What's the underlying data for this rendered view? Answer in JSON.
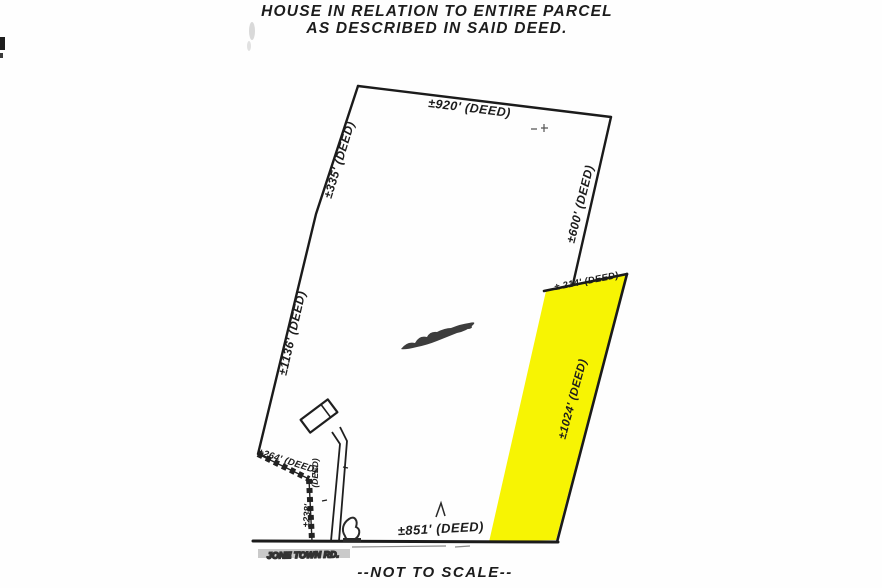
{
  "document": {
    "title_line1": "HOUSE IN RELATION TO ENTIRE PARCEL",
    "title_line2": "AS DESCRIBED IN SAID DEED.",
    "scale_note": "--NOT TO SCALE--"
  },
  "road": {
    "name": "JONE TOWN RD."
  },
  "colors": {
    "highlight": "#f7f403",
    "ink": "#1c1c1c"
  },
  "dimensions": {
    "north": "±920' (DEED)",
    "west_upper": "±335' (DEED)",
    "west_lower": "±1136' (DEED)",
    "east_upper": "±600' (DEED)",
    "strip_north": "± 214' (DEED)",
    "strip_east": "±1024' (DEED)",
    "southwest_diagonal": "±264' (DEED)",
    "driveway_deed": "(DEED)",
    "driveway_length": "±238'",
    "south": "±851' (DEED)"
  }
}
